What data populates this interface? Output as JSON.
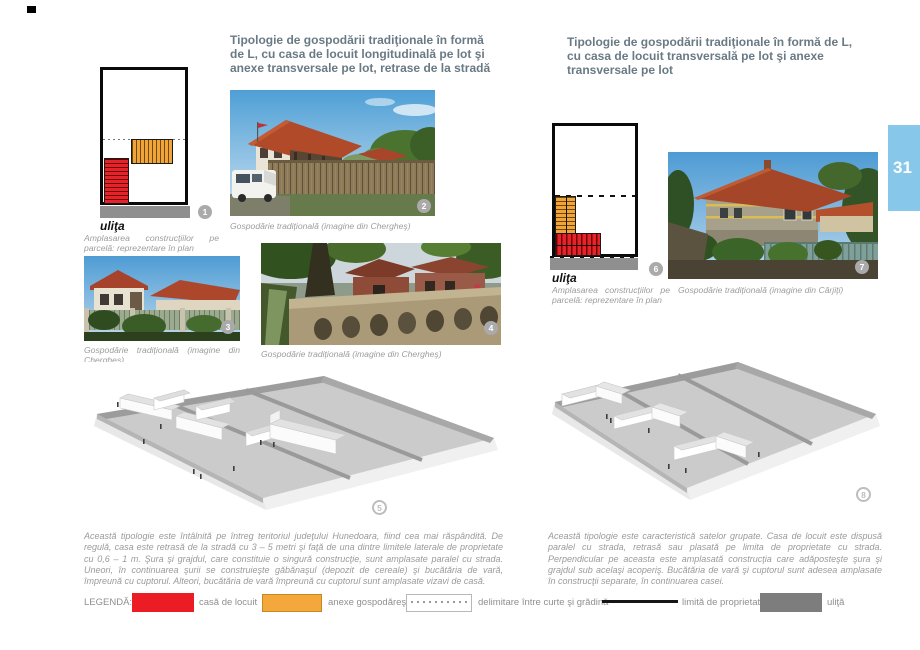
{
  "page": {
    "number": "31",
    "tab_color": "#87c7ea"
  },
  "left": {
    "heading": "Tipologie de gospodării tradiţionale în formă de L, cu casa de locuit longitudinală pe lot şi anexe transversale pe lot, retrase de la stradă",
    "plan": {
      "street": "uliţa",
      "caption": "Amplasarea construcţiilor pe parcelă: reprezentare în plan",
      "fig": "1"
    },
    "photo_main": {
      "caption": "Gospodărie tradiţională (imagine din Chergheş)",
      "fig": "2"
    },
    "photo_a": {
      "caption": "Gospodărie tradiţională (imagine din Chergheş)",
      "fig": "3"
    },
    "photo_b": {
      "caption": "Gospodărie tradiţională (imagine din Chergheş)",
      "fig": "4"
    },
    "rendering": {
      "fig": "5"
    },
    "body": "Această tipologie este întâlnită pe întreg teritoriul judeţului Hunedoara, fiind cea mai răspândită. De regulă, casa este retrasă de la stradă cu 3 – 5 metri şi faţă de una dintre limitele laterale de proprietate cu 0,6 – 1 m. Şura şi grajdul, care constituie o singură construcţie, sunt amplasate paralel cu strada. Uneori, în continuarea şurii se construieşte găbănaşul (depozit de cereale) şi bucătăria de vară, împreună cu cuptorul. Alteori, bucătăria de vară împreună cu cuptorul sunt amplasate vizavi de casă."
  },
  "right": {
    "heading": "Tipologie de gospodării tradiţionale în formă de L, cu casa de locuit transversală pe lot şi anexe transversale pe lot",
    "plan": {
      "street": "uliţa",
      "caption": "Amplasarea construcţiilor pe parcelă: reprezentare în plan",
      "fig": "6"
    },
    "photo_main": {
      "caption": "Gospodărie tradiţională (imagine din Cârjiţi)",
      "fig": "7"
    },
    "rendering": {
      "fig": "8"
    },
    "body": "Această tipologie este caracteristică satelor grupate. Casa de locuit este dispusă paralel cu strada, retrasă sau plasată pe limita de proprietate cu strada. Perpendicular pe aceasta este amplasată construcţia care adăposteşte şura şi grajdul sub acelaşi acoperiş. Bucătăria de vară şi cuptorul sunt adesea amplasate în construcţii separate, în continuarea casei."
  },
  "legend": {
    "title": "LEGENDĂ:",
    "items": [
      {
        "label": "casă de locuit",
        "color": "#ec1c24"
      },
      {
        "label": "anexe gospodăreşti",
        "color": "#f4a73a"
      },
      {
        "label": "delimitare între curte şi grădină",
        "style": "dotted"
      },
      {
        "label": "limită de proprietate",
        "style": "line"
      },
      {
        "label": "uliţă",
        "color": "#7d7d7d"
      }
    ]
  }
}
